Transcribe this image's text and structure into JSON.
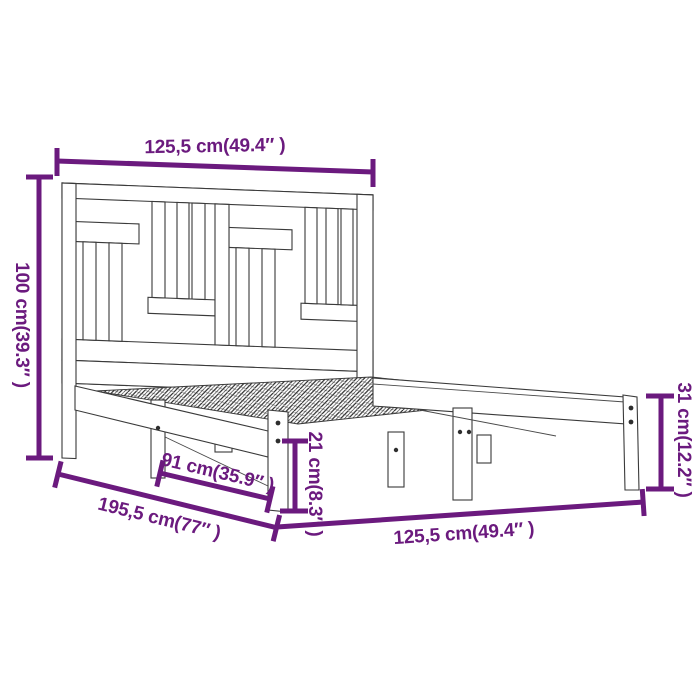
{
  "diagram": {
    "type": "product-dimension-diagram",
    "subject": "wooden-bed-frame-with-headboard",
    "dimensions": {
      "top_width": "125,5 cm(49.4″ )",
      "headboard_height": "100 cm(39.3″ )",
      "foot_height": "31 cm(12.2″ )",
      "slat_length": "91 cm(35.9″ )",
      "total_length": "195,5 cm(77″ )",
      "base_height": "21 cm(8.3″ )",
      "bottom_width": "125,5 cm(49.4″ )"
    },
    "colors": {
      "dimension_accent": "#6B1A7E",
      "line_art": "#3A3A3A",
      "background": "#FFFFFF"
    }
  }
}
